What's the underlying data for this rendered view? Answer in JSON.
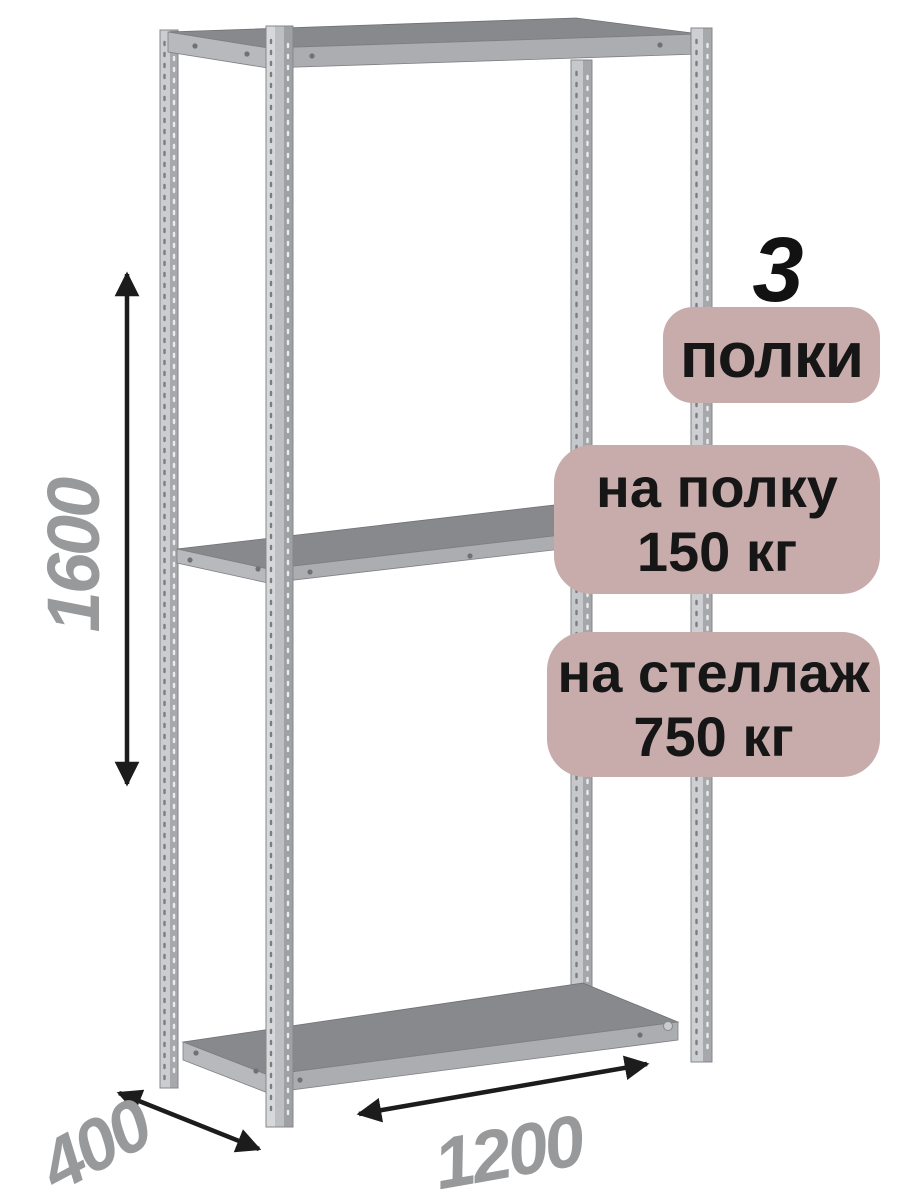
{
  "product": {
    "shelf_count": "3",
    "shelves_label": "полки",
    "per_shelf_load_line1": "на полку",
    "per_shelf_load_line2": "150 кг",
    "total_load_line1": "на стеллаж",
    "total_load_line2": "750 кг"
  },
  "dimensions": {
    "height": "1600",
    "depth": "400",
    "width": "1200"
  },
  "colors": {
    "badge_bg": "#c8abab",
    "badge_text": "#161616",
    "count_text": "#121212",
    "dim_text": "#98999b",
    "arrow": "#1c1c1c",
    "shelf_top": "#87898d",
    "shelf_front": "#abadb1",
    "shelf_side": "#b7b9bc",
    "post_outline": "#85878b",
    "bg": "#ffffff"
  }
}
